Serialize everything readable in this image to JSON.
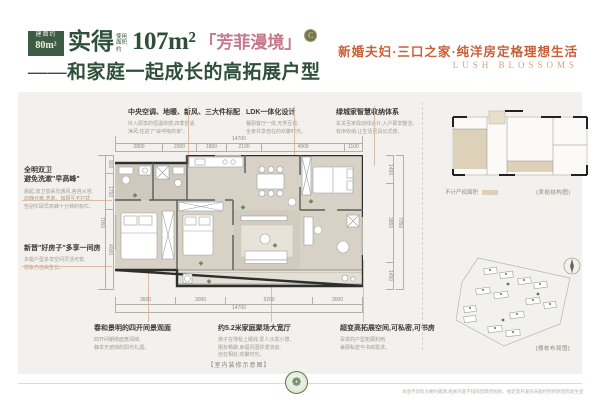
{
  "header": {
    "badge_line1": "建面约",
    "badge_line2": "80m²",
    "title_pre": "实得",
    "title_small": "使用面积约",
    "title_area": "107m²",
    "title_name": "「芳菲漫境」",
    "title_grade": "C",
    "subtitle": "——和家庭一起成长的高拓展户型",
    "tagline": "新婚夫妇·三口之家·纯洋房定格理想生活",
    "tagline_en": "LUSH BLOSSOMS"
  },
  "callouts": {
    "top": [
      {
        "title": "中央空调、地暖、新风、三大件标配",
        "desc": "拎入即享的恒温体感,四季舒适,\n净风,住进了\"会呼吸的家\"。"
      },
      {
        "title": "LDK一体化设计",
        "desc": "餐厨客厅一体,无界互动,\n全家共享自在的欢聚时光。"
      },
      {
        "title": "绿城家智慧收纳体系",
        "desc": "玄关至家政动线设计,入户即享整洁,\n有序收纳,让生活更具仪式感。"
      }
    ],
    "left": [
      {
        "title": "全明双卫\n避免洗漱\"早高峰\"",
        "desc": "晨起,双卫皆采光通风,各自从容,\n动静分离,洗漱、如厕互不打扰,\n告别忙碌早高峰十分钟的匆忙。"
      },
      {
        "title": "新晋\"好房子\"多享一间房",
        "desc": "多能户型多享空间灵活可变,\n想象力自由生长。"
      }
    ],
    "bottom": [
      {
        "title": "春和景明的四开间景观面",
        "desc": "四开间朝南面宽阔绰,\n静享无遮挡的阳光礼遇。"
      },
      {
        "title": "约5.2米家庭聚场大宽厅",
        "desc": "孩子在地毯上嬉戏,爱人沙发小憩,\n朋友畅聊,幸福氛围弥漫流动,\n自在相处,欢聚时光。"
      },
      {
        "title": "超变高拓展空间,可私密,可书房",
        "desc": "百变的户型拓展利用,\n兼顾私密与书房需求。"
      }
    ]
  },
  "dims": {
    "top_total": "14700",
    "top_segments": [
      "2800",
      "2000",
      "1800",
      "2100",
      "4900",
      "1100"
    ],
    "bottom_segments": [
      "3600",
      "3000",
      "5200",
      "3000"
    ],
    "bottom_total": "14700",
    "left_segments": [
      "900",
      "1750",
      "4000"
    ],
    "left_total": "7050",
    "right_segments": [
      "1450",
      "3850",
      "1450"
    ],
    "right_total": "7050"
  },
  "plan_caption": "【室内装修示意图】",
  "right_panel": {
    "legend": "不计产权面积",
    "original_label": "(原始结构图)",
    "site_label": "[楼栋布局图]"
  },
  "footer": {
    "emblem_glyph": "❁",
    "disclaimer": "本宣传资料为要约邀请,相关内容不排除因政府规划、规定及开发商未能控制的原因而发生变化,最终以政府批文及商品房买卖合同约定为准,开发商保留对宣传资料修改的权利,敬请留意最新资料。"
  },
  "colors": {
    "deep_green": "#2f4f3a",
    "badge_green": "#3c5c46",
    "rose": "#c4798c",
    "orange": "#c95f36",
    "orange_light": "#d8a181",
    "panel_bg": "#f3f1ed",
    "floor_beige": "#d8d2c6",
    "marker_green": "#6c8c5e"
  }
}
